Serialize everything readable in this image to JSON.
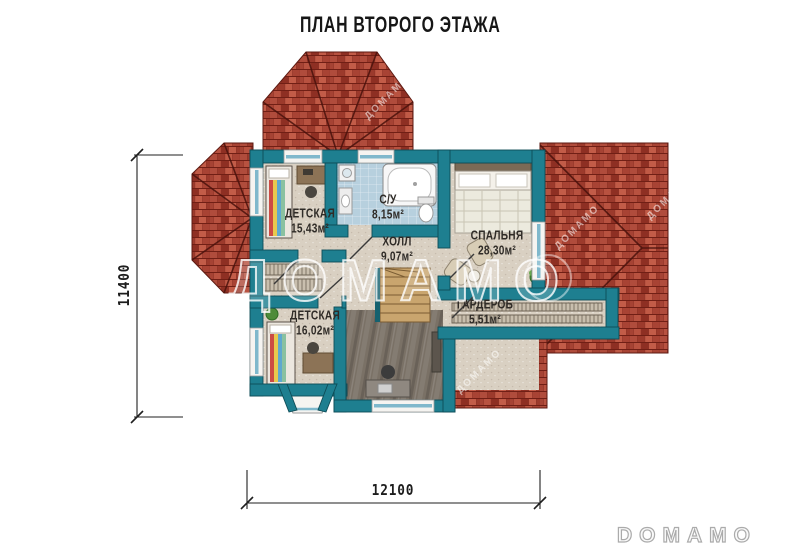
{
  "title": "ПЛАН ВТОРОГО ЭТАЖА",
  "rooms": {
    "kids1": {
      "name": "ДЕТСКАЯ",
      "area": "15,43м²"
    },
    "bath": {
      "name": "С/У",
      "area": "8,15м²"
    },
    "hall": {
      "name": "ХОЛЛ",
      "area": "9,07м²"
    },
    "bedroom": {
      "name": "СПАЛЬНЯ",
      "area": "28,30м²"
    },
    "wardrobe": {
      "name": "ГАРДЕРОБ",
      "area": "5,51м²"
    },
    "kids2": {
      "name": "ДЕТСКАЯ",
      "area": "16,02м²"
    }
  },
  "dimensions": {
    "height_mm": "11400",
    "width_mm": "12100"
  },
  "watermark": {
    "large": "ДОМАМО",
    "small": "ДОМАМО"
  },
  "brand": {
    "logo": "DOMAMO"
  },
  "colors": {
    "wall": "#1e7f90",
    "wall_outline": "#0e4c57",
    "roof": "#a0392c",
    "floor": "#d9d0c2",
    "bath_floor": "#b7d0de",
    "wood_floor": "#7a7166",
    "stair_wood": "#c9a56e",
    "glass": "#7fb8cc",
    "text": "#2f2b27"
  }
}
